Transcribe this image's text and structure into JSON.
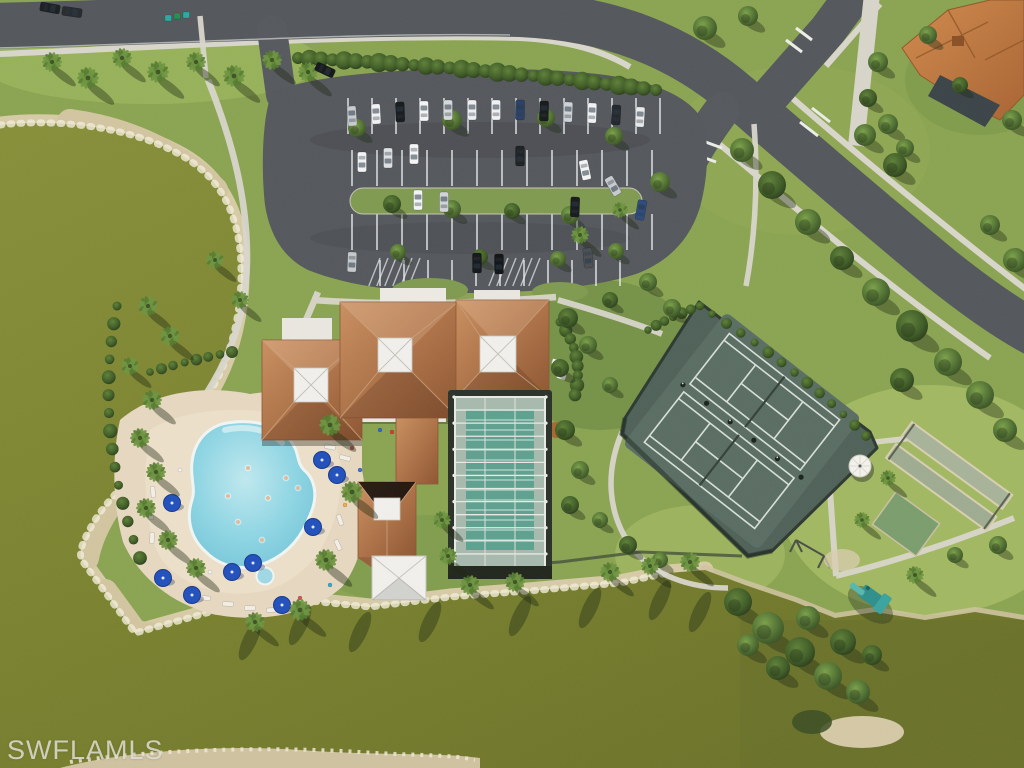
{
  "watermark": {
    "text": "SWFLAMLS"
  },
  "scene": {
    "type": "aerial-photo",
    "description": "Aerial view of a community amenity campus: clubhouse with terracotta hip roofs and white cupolas, free-form swimming pool with blue umbrellas, screened lap pool, tennis courts, bocce courts, playground, curved parking lot with cars, roads and two olive-green lakes with sandy shorelines",
    "palette": {
      "grass": "#8aa451",
      "grass_light": "#a2b862",
      "grass_dark": "#6f8c44",
      "water": "#7c8432",
      "water_dark": "#6d7429",
      "shore_sand": "#d7cba6",
      "shore_speckle": "#f3ecd9",
      "road": "#53575c",
      "parking_asphalt": "#54575c",
      "sidewalk": "#d9d6cb",
      "roof_terracotta": "#b0764c",
      "roof_white": "#f1f0ec",
      "pool_water": "#8fd6e4",
      "pool_deck": "#e7d8c0",
      "lap_pool": "#5ea08f",
      "screen_enclosure": "#a7b9ae",
      "tennis_pad": "#51635a",
      "tennis_line": "#d8e0da",
      "bocce_court": "#a7b399",
      "green_court": "#7b9d6d",
      "playground_teal": "#2e8f8c",
      "umbrella_blue": "#2150bc",
      "house_roof": "#c0793f"
    }
  },
  "cars": [
    [
      50,
      8,
      100,
      "#1b1e21"
    ],
    [
      72,
      12,
      98,
      "#26292d"
    ],
    [
      325,
      70,
      115,
      "#141619"
    ],
    [
      352,
      116,
      -4,
      "#c9ccd0"
    ],
    [
      376,
      114,
      -3,
      "#f2f3f4"
    ],
    [
      400,
      112,
      -2,
      "#17191c"
    ],
    [
      424,
      111,
      -1,
      "#f4f5f6"
    ],
    [
      448,
      110,
      0,
      "#d7d9dc"
    ],
    [
      472,
      110,
      0,
      "#eef0f1"
    ],
    [
      496,
      110,
      0,
      "#f1f2f3"
    ],
    [
      520,
      110,
      1,
      "#2a3f66"
    ],
    [
      544,
      111,
      1,
      "#16181a"
    ],
    [
      568,
      112,
      2,
      "#cfd3d6"
    ],
    [
      592,
      113,
      2,
      "#f1f2f3"
    ],
    [
      616,
      115,
      3,
      "#22262a"
    ],
    [
      640,
      117,
      3,
      "#e8eaec"
    ],
    [
      362,
      162,
      180,
      "#f3f4f5"
    ],
    [
      388,
      158,
      180,
      "#dfe1e3"
    ],
    [
      414,
      154,
      180,
      "#f5f6f7"
    ],
    [
      520,
      156,
      180,
      "#1d2023"
    ],
    [
      585,
      170,
      168,
      "#f4f5f6"
    ],
    [
      613,
      186,
      150,
      "#c8cbcf"
    ],
    [
      418,
      200,
      0,
      "#f4f5f6"
    ],
    [
      444,
      202,
      0,
      "#d2d5d8"
    ],
    [
      575,
      207,
      2,
      "#17191c"
    ],
    [
      641,
      210,
      10,
      "#2c4a7c"
    ],
    [
      352,
      262,
      182,
      "#c6c9cc"
    ],
    [
      477,
      263,
      180,
      "#141619"
    ],
    [
      499,
      264,
      180,
      "#101214"
    ],
    [
      588,
      258,
      175,
      "#4a4e53"
    ]
  ],
  "parking_rows": [
    {
      "x0": 348,
      "x1": 662,
      "step": 24,
      "y0": 98,
      "y1": 134
    },
    {
      "x0": 352,
      "x1": 652,
      "step": 25,
      "y0": 150,
      "y1": 186
    },
    {
      "x0": 352,
      "x1": 652,
      "step": 25,
      "y0": 214,
      "y1": 250
    },
    {
      "x0": 380,
      "x1": 642,
      "step": 24,
      "y0": 260,
      "y1": 286
    }
  ],
  "hatches": [
    {
      "x": 380,
      "y": 258,
      "w": 40,
      "h": 28
    },
    {
      "x": 500,
      "y": 258,
      "w": 40,
      "h": 28
    }
  ],
  "hedges": [
    {
      "pts": [
        [
          298,
          58
        ],
        [
          470,
          66
        ],
        [
          656,
          90
        ]
      ],
      "n": 30,
      "r": 8
    },
    {
      "pts": [
        [
          117,
          306
        ],
        [
          92,
          430
        ],
        [
          140,
          558
        ]
      ],
      "n": 14,
      "r": 6
    },
    {
      "pts": [
        [
          712,
          314
        ],
        [
          800,
          370
        ],
        [
          866,
          436
        ]
      ],
      "n": 12,
      "r": 5
    },
    {
      "pts": [
        [
          648,
          330
        ],
        [
          672,
          316
        ],
        [
          700,
          306
        ]
      ],
      "n": 6,
      "r": 5
    },
    {
      "pts": [
        [
          150,
          372
        ],
        [
          190,
          360
        ],
        [
          232,
          352
        ]
      ],
      "n": 7,
      "r": 5
    },
    {
      "pts": [
        [
          560,
          322
        ],
        [
          585,
          355
        ],
        [
          575,
          395
        ]
      ],
      "n": 8,
      "r": 6
    }
  ],
  "trees": [
    [
      357,
      128,
      9,
      0
    ],
    [
      452,
      120,
      10,
      0
    ],
    [
      546,
      118,
      9,
      0
    ],
    [
      614,
      136,
      9,
      0
    ],
    [
      660,
      182,
      10,
      0
    ],
    [
      392,
      204,
      9,
      1
    ],
    [
      452,
      209,
      9,
      0
    ],
    [
      512,
      211,
      8,
      1
    ],
    [
      570,
      215,
      9,
      0
    ],
    [
      398,
      252,
      8,
      0
    ],
    [
      480,
      257,
      8,
      1
    ],
    [
      558,
      259,
      8,
      0
    ],
    [
      616,
      251,
      8,
      0
    ],
    [
      705,
      28,
      12,
      0
    ],
    [
      748,
      16,
      10,
      0
    ],
    [
      742,
      150,
      12,
      0
    ],
    [
      772,
      185,
      14,
      1
    ],
    [
      808,
      222,
      13,
      0
    ],
    [
      842,
      258,
      12,
      1
    ],
    [
      876,
      292,
      14,
      0
    ],
    [
      912,
      326,
      16,
      1
    ],
    [
      948,
      362,
      14,
      0
    ],
    [
      902,
      380,
      12,
      1
    ],
    [
      980,
      395,
      14,
      0
    ],
    [
      1005,
      430,
      12,
      0
    ],
    [
      865,
      135,
      11,
      0
    ],
    [
      895,
      165,
      12,
      1
    ],
    [
      990,
      225,
      10,
      0
    ],
    [
      1015,
      260,
      12,
      0
    ],
    [
      648,
      282,
      9,
      0
    ],
    [
      610,
      300,
      8,
      1
    ],
    [
      672,
      308,
      9,
      0
    ],
    [
      998,
      545,
      9,
      0
    ],
    [
      955,
      555,
      8,
      0
    ],
    [
      738,
      602,
      14,
      1
    ],
    [
      768,
      628,
      16,
      0
    ],
    [
      800,
      652,
      15,
      1
    ],
    [
      828,
      676,
      14,
      0
    ],
    [
      778,
      668,
      12,
      1
    ],
    [
      808,
      618,
      12,
      0
    ],
    [
      843,
      642,
      13,
      1
    ],
    [
      858,
      692,
      12,
      0
    ],
    [
      748,
      645,
      11,
      0
    ],
    [
      872,
      655,
      10,
      1
    ],
    [
      568,
      318,
      10,
      1
    ],
    [
      588,
      345,
      9,
      0
    ],
    [
      560,
      368,
      9,
      1
    ],
    [
      610,
      385,
      8,
      0
    ],
    [
      565,
      430,
      10,
      1
    ],
    [
      580,
      470,
      9,
      0
    ],
    [
      570,
      505,
      9,
      1
    ],
    [
      600,
      520,
      8,
      0
    ],
    [
      628,
      545,
      9,
      1
    ],
    [
      660,
      560,
      8,
      0
    ],
    [
      878,
      62,
      10,
      0
    ],
    [
      868,
      98,
      9,
      1
    ],
    [
      888,
      124,
      10,
      0
    ],
    [
      905,
      148,
      9,
      0
    ],
    [
      928,
      35,
      9,
      0
    ],
    [
      1012,
      120,
      10,
      0
    ],
    [
      960,
      85,
      8,
      1
    ]
  ],
  "palms": [
    [
      52,
      62,
      10
    ],
    [
      88,
      78,
      11
    ],
    [
      122,
      58,
      10
    ],
    [
      158,
      72,
      11
    ],
    [
      196,
      62,
      10
    ],
    [
      234,
      76,
      11
    ],
    [
      272,
      60,
      10
    ],
    [
      308,
      72,
      10
    ],
    [
      148,
      306,
      10
    ],
    [
      170,
      336,
      10
    ],
    [
      130,
      366,
      9
    ],
    [
      152,
      400,
      10
    ],
    [
      140,
      438,
      10
    ],
    [
      156,
      472,
      10
    ],
    [
      146,
      508,
      10
    ],
    [
      168,
      540,
      10
    ],
    [
      196,
      568,
      10
    ],
    [
      330,
      425,
      11
    ],
    [
      352,
      492,
      11
    ],
    [
      326,
      560,
      11
    ],
    [
      300,
      610,
      11
    ],
    [
      255,
      622,
      10
    ],
    [
      470,
      585,
      10
    ],
    [
      515,
      582,
      10
    ],
    [
      610,
      572,
      10
    ],
    [
      650,
      566,
      9
    ],
    [
      690,
      562,
      10
    ],
    [
      442,
      520,
      9
    ],
    [
      448,
      556,
      9
    ],
    [
      915,
      575,
      9
    ],
    [
      862,
      520,
      8
    ],
    [
      888,
      478,
      8
    ],
    [
      580,
      235,
      9
    ],
    [
      620,
      210,
      8
    ],
    [
      240,
      300,
      9
    ],
    [
      215,
      260,
      9
    ]
  ],
  "water_streaks": [
    [
      300,
      625
    ],
    [
      360,
      632
    ],
    [
      430,
      622
    ],
    [
      520,
      616
    ],
    [
      590,
      608
    ],
    [
      660,
      600
    ],
    [
      700,
      612
    ],
    [
      250,
      640
    ]
  ],
  "umbrellas": [
    [
      172,
      503
    ],
    [
      322,
      460
    ],
    [
      337,
      475
    ],
    [
      313,
      527
    ],
    [
      163,
      578
    ],
    [
      192,
      595
    ],
    [
      232,
      572
    ],
    [
      253,
      563
    ],
    [
      282,
      605
    ]
  ],
  "loungers": [
    [
      156,
      470,
      80
    ],
    [
      153,
      492,
      85
    ],
    [
      151,
      514,
      88
    ],
    [
      152,
      538,
      92
    ],
    [
      310,
      437,
      10
    ],
    [
      330,
      447,
      12
    ],
    [
      345,
      458,
      15
    ],
    [
      205,
      598,
      5
    ],
    [
      228,
      604,
      2
    ],
    [
      250,
      608,
      0
    ],
    [
      272,
      610,
      -4
    ],
    [
      296,
      606,
      -8
    ],
    [
      340,
      520,
      70
    ],
    [
      338,
      545,
      65
    ]
  ],
  "pool_people": [
    [
      248,
      468
    ],
    [
      268,
      498
    ],
    [
      238,
      522
    ],
    [
      286,
      478
    ],
    [
      262,
      540
    ],
    [
      298,
      488
    ],
    [
      228,
      496
    ]
  ],
  "deck_people": [
    [
      352,
      448,
      "#d9534f"
    ],
    [
      360,
      470,
      "#3a6fd8"
    ],
    [
      345,
      505,
      "#f0ad4e"
    ],
    [
      210,
      572,
      "#f5f5f5"
    ],
    [
      300,
      598,
      "#d9534f"
    ],
    [
      330,
      585,
      "#33aacc"
    ],
    [
      180,
      470,
      "#f5f5f5"
    ],
    [
      380,
      430,
      "#3366cc"
    ],
    [
      392,
      432,
      "#e03333"
    ],
    [
      404,
      430,
      "#eeeeee"
    ],
    [
      416,
      433,
      "#22aaaa"
    ]
  ],
  "bins": [
    [
      168,
      18,
      "#2aa8a0"
    ],
    [
      177,
      16,
      "#2a8a50"
    ],
    [
      186,
      15,
      "#2aa8a0"
    ]
  ],
  "carts": [
    [
      556,
      362
    ],
    [
      561,
      376
    ]
  ],
  "enclosure": {
    "x": 455,
    "y": 397,
    "w": 90,
    "h": 170,
    "rows": 13,
    "cols": 3,
    "pool": {
      "x": 466,
      "y": 410,
      "w": 68,
      "h": 140,
      "lanes": 14
    }
  }
}
